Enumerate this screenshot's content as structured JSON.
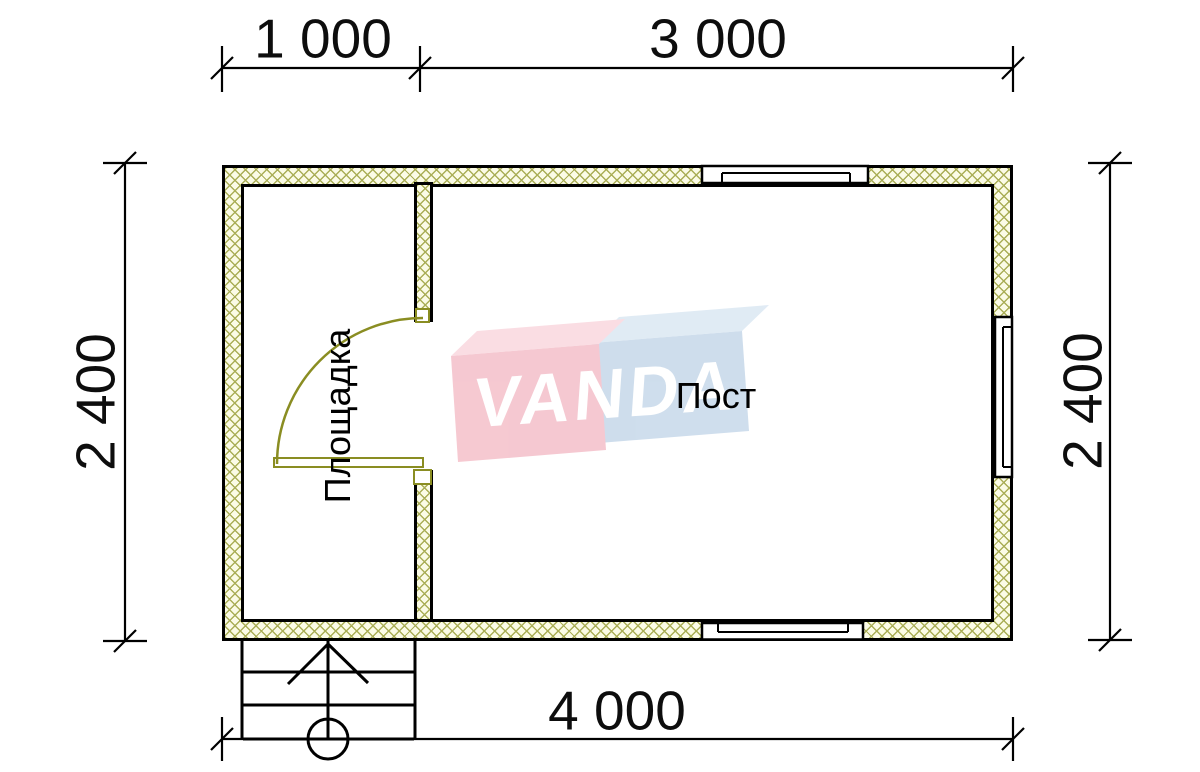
{
  "dimensions": {
    "top_left_segment": "1 000",
    "top_right_segment": "3 000",
    "left_side": "2 400",
    "right_side": "2 400",
    "bottom_total": "4 000"
  },
  "rooms": {
    "entry_room_label": "Площадка",
    "main_room_label": "Пост"
  },
  "watermark": {
    "text": "VANDA"
  },
  "colors": {
    "wall_hatch": "#aaae57",
    "wall_fill": "#fbfbe6",
    "door_olive": "#8a8d22",
    "outline": "#000000",
    "logo_pink": "#f5c6cf",
    "logo_pink_top": "#fadce2",
    "logo_blue": "#ccdcec",
    "logo_blue_top": "#dfeaf4"
  }
}
